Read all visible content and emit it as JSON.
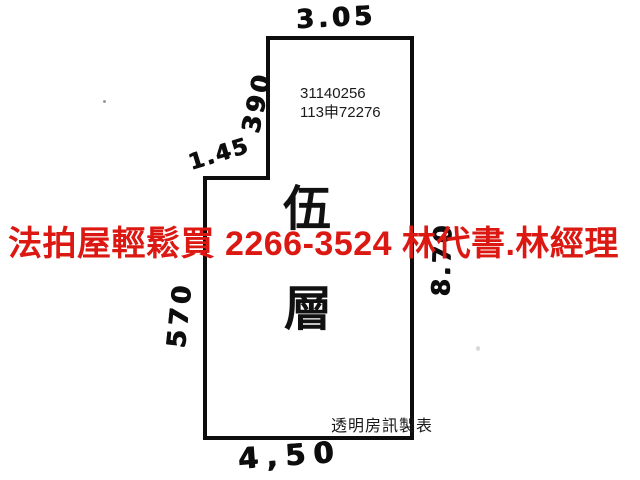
{
  "plan": {
    "dimensions": {
      "top": "3.05",
      "left_upper": "390",
      "notch": "1.45",
      "left_lower": "570",
      "right": "8.70",
      "bottom": "4,50"
    },
    "case_numbers": {
      "line1": "31140256",
      "line2": "113申72276"
    },
    "floor": [
      "伍",
      "層"
    ],
    "credit": "透明房訊製表"
  },
  "overlay": {
    "text": "法拍屋輕鬆買  2266-3524  林代書.林經理",
    "color": "#dc1812"
  },
  "colors": {
    "outline": "#0d0d0d",
    "background": "#ffffff"
  }
}
